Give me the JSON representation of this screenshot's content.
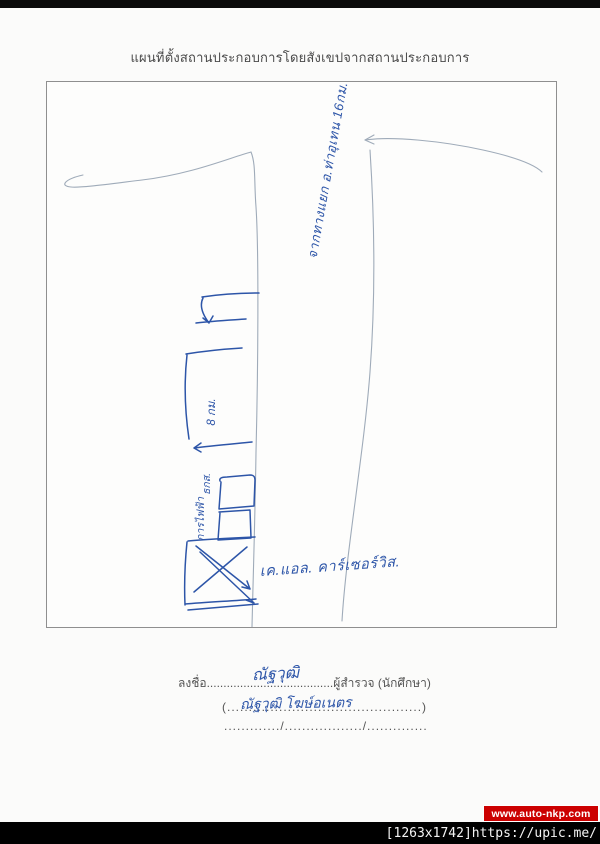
{
  "page": {
    "title": "แผนที่ตั้งสถานประกอบการโดยสังเขปจากสถานประกอบการ"
  },
  "map_sketch": {
    "road_label": "จากทางแยก อ.ท่าอุเทน 16กม.",
    "distance_label": "8 กม.",
    "poi_bank": "ธกส.",
    "poi_electric": "การไฟฟ้า",
    "destination_label": "เค.แอล. คาร์เซอร์วิส."
  },
  "signature_block": {
    "sign_prefix": "ลงชื่อ",
    "dots_after_sign": "......................................",
    "surveyor_label": "ผู้สำรวจ (นักศึกษา)",
    "signature_handwritten": "ณัฐวุฒิ",
    "name_line": "(.............................................)",
    "name_handwritten": "ณัฐวุฒิ โฆษ์อเนตร",
    "date_line": "............./................../.............."
  },
  "watermarks": {
    "site": "www.auto-nkp.com",
    "image_info": "[1263x1742]https://upic.me/"
  },
  "colors": {
    "ink_blue": "#2d55a8",
    "faint_ink": "#9fabb9",
    "banner_red": "#cc0000",
    "printed_text": "#4a4a4a",
    "page_bg": "#fbfbfa",
    "bar_bg": "#000000"
  }
}
